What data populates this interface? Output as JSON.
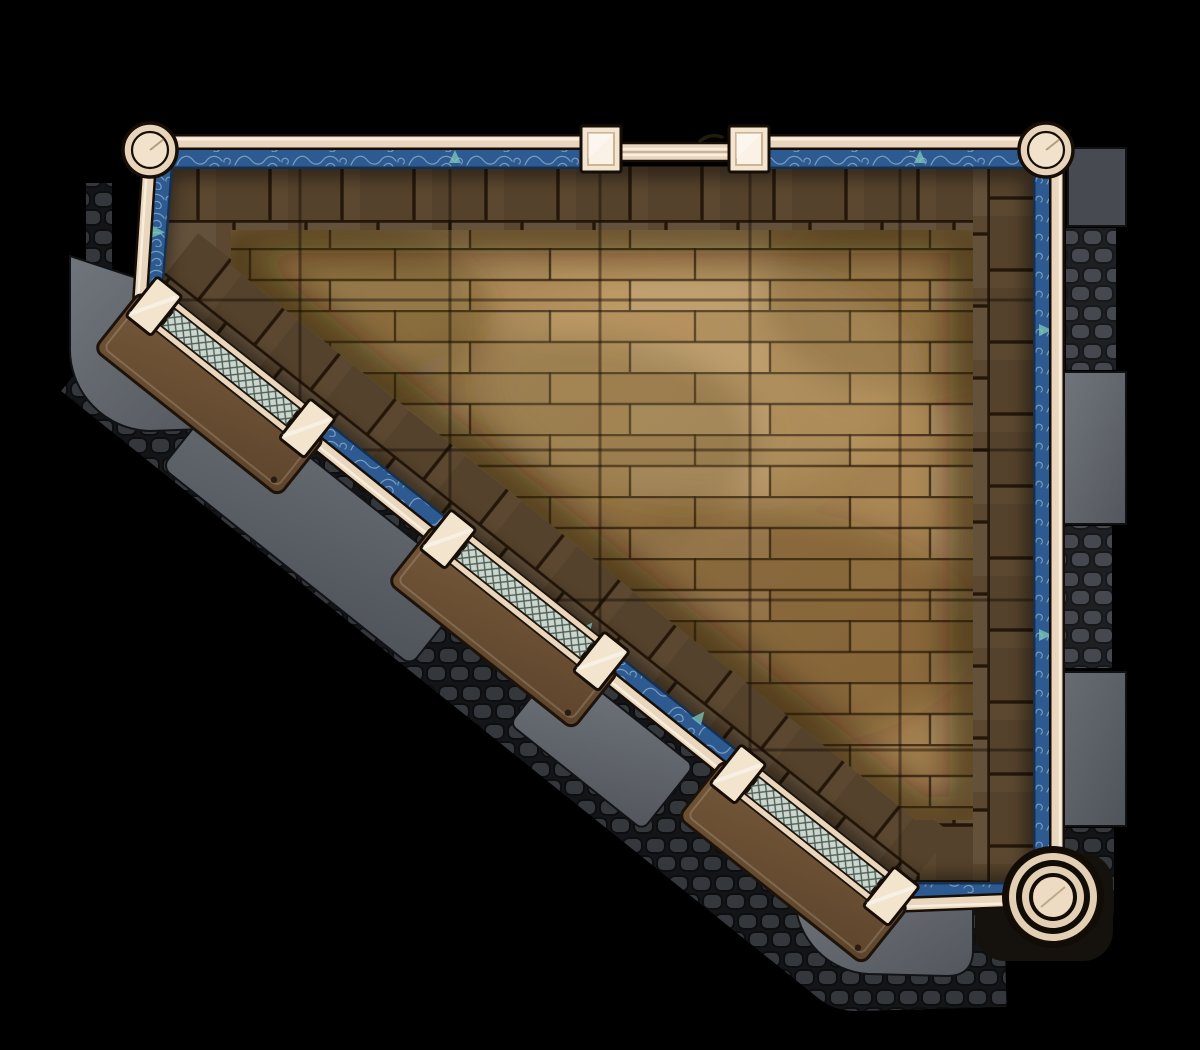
{
  "map": {
    "title": "triangular-hall-battlemap",
    "width_px": 1200,
    "height_px": 1050,
    "grid": {
      "cell_px": 150,
      "cols": 8,
      "rows": 7,
      "visible": true
    }
  },
  "palette": {
    "background": "#000000",
    "wood_light": "#bd9a64",
    "wood_dark": "#a3804e",
    "wood_joint": "#2b1c0d",
    "brick": "#5c4830",
    "brick_mortar": "#241709",
    "carpet_blue": "#2d5a91",
    "carpet_blue_dark": "#16314f",
    "carpet_swirl": "#aac6de",
    "carpet_accent_teal": "#7fcaba",
    "rail_cream": "#e9d6bd",
    "rail_highlight": "#f7eedd",
    "rail_outline": "#160e07",
    "stone_slab_light": "#70757c",
    "stone_slab_dark": "#53575d",
    "cobble_stone": "#45484e",
    "cobble_gap": "#1e2024",
    "cobble_dark_stone": "#34373c",
    "cobble_dark_gap": "#141518",
    "platform_brown": "#6b4e32",
    "platform_outline": "#1d130a",
    "lattice_bg": "#ccd6ce",
    "lattice_line": "#4e6156"
  },
  "scene": {
    "room_shape": "right-trapezoid with diagonal south-west wall",
    "floor": "horizontal wood planks with dark brick tile border",
    "carpet_trim": "blue band with light swirl flourishes and teal sail accents along inside of railing",
    "corner_posts": [
      {
        "name": "top-left-post",
        "x": 150,
        "y": 150,
        "style": "small-ring"
      },
      {
        "name": "top-right-post",
        "x": 1046,
        "y": 150,
        "style": "small-ring"
      },
      {
        "name": "bottom-right-post",
        "x": 1053,
        "y": 897,
        "style": "large-multi-ring"
      }
    ],
    "gate": {
      "location": "top wall center",
      "post_left": {
        "x": 581,
        "y": 126
      },
      "post_right": {
        "x": 729,
        "y": 126
      },
      "bars": 2,
      "latch": true
    },
    "benches": [
      {
        "x": 230,
        "y": 368,
        "angle": 38.55
      },
      {
        "x": 524,
        "y": 601,
        "angle": 38.55
      },
      {
        "x": 814,
        "y": 836,
        "angle": 38.55
      }
    ],
    "outside_stonework": {
      "right_column_blocks": 6,
      "diagonal_slabs": 4,
      "texture": "alternating smooth slabs and cobblestone courses"
    }
  }
}
